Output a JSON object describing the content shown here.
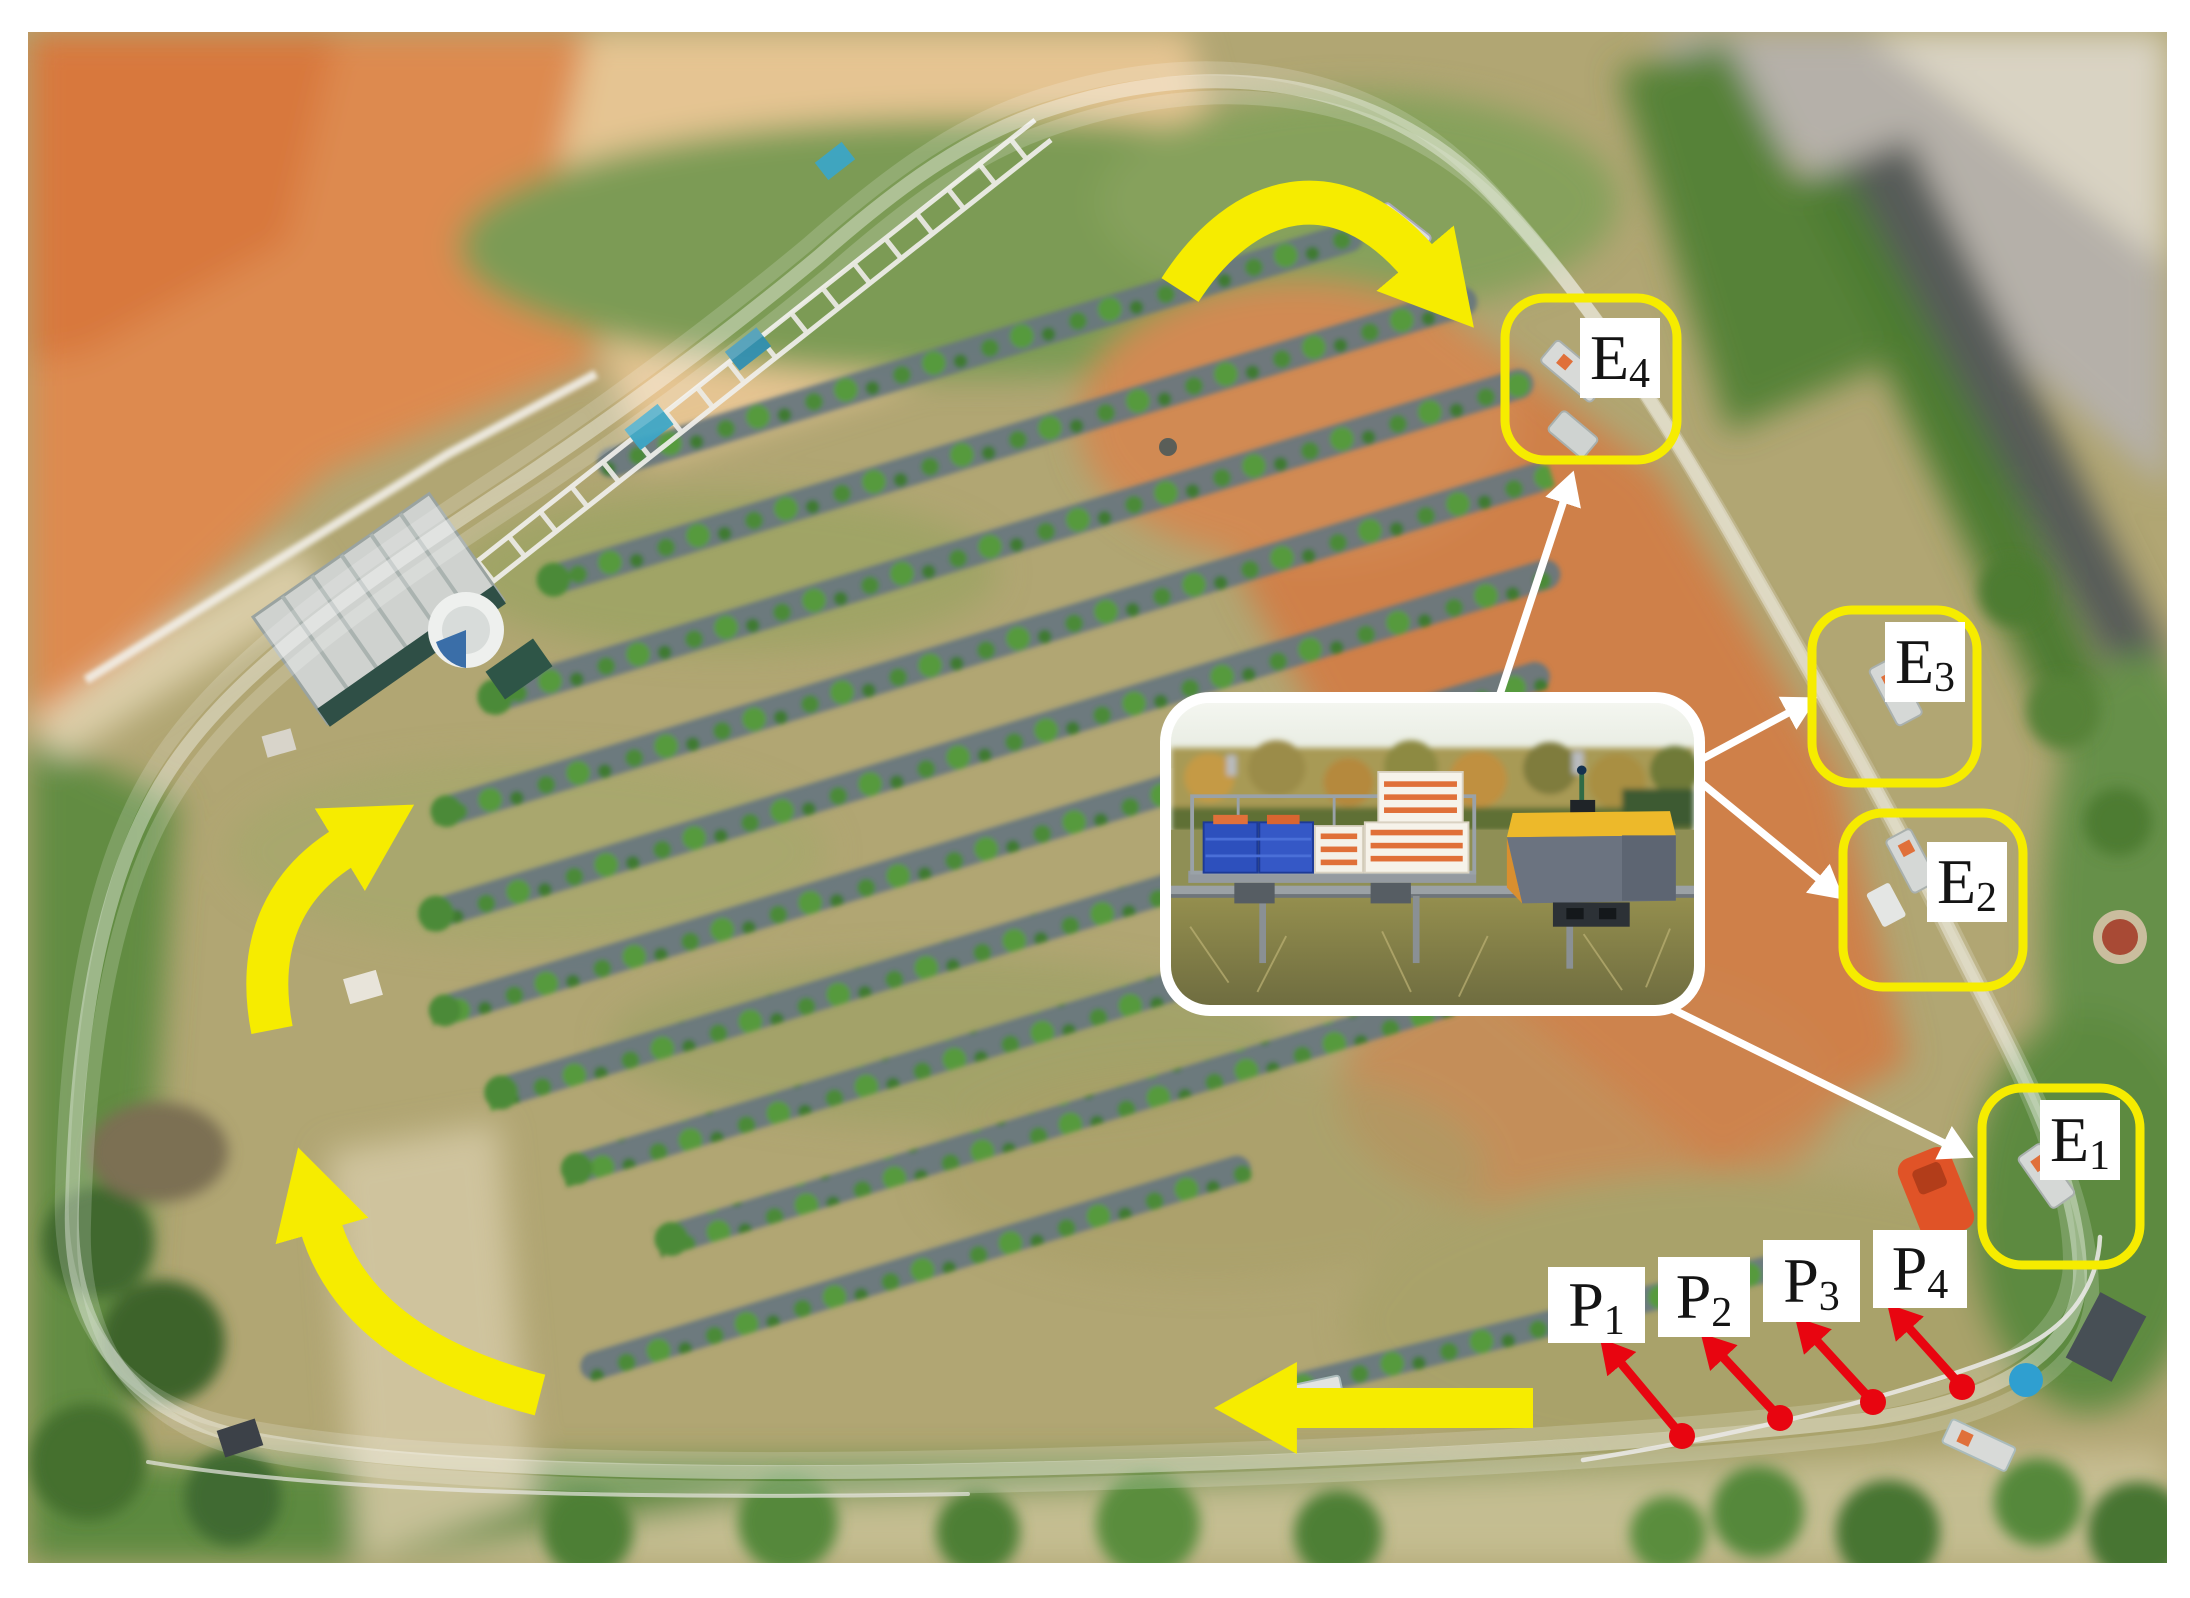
{
  "figure": {
    "title": "Aerial view of orchard monorail transport system with station and loading-point annotations"
  },
  "annotations": {
    "stations": [
      {
        "id": "E4",
        "base": "E",
        "sub": "4"
      },
      {
        "id": "E3",
        "base": "E",
        "sub": "3"
      },
      {
        "id": "E2",
        "base": "E",
        "sub": "2"
      },
      {
        "id": "E1",
        "base": "E",
        "sub": "1"
      }
    ],
    "points": [
      {
        "id": "P1",
        "base": "P",
        "sub": "1"
      },
      {
        "id": "P2",
        "base": "P",
        "sub": "2"
      },
      {
        "id": "P3",
        "base": "P",
        "sub": "3"
      },
      {
        "id": "P4",
        "base": "P",
        "sub": "4"
      }
    ],
    "route_arrows": [
      {
        "name": "route-arrow-top-curve",
        "shape": "curved",
        "direction": "down-right"
      },
      {
        "name": "route-arrow-left-upper-curve",
        "shape": "curved",
        "direction": "up-right"
      },
      {
        "name": "route-arrow-left-lower-curve",
        "shape": "curved",
        "direction": "up"
      },
      {
        "name": "route-arrow-bottom-straight",
        "shape": "straight",
        "direction": "left"
      }
    ],
    "pointer_arrows_white": [
      "to-E4",
      "to-E3",
      "to-E2",
      "to-E1"
    ],
    "pointer_arrows_red": [
      "to-P1",
      "to-P2",
      "to-P3",
      "to-P4"
    ]
  },
  "colors": {
    "route_yellow": "#f6ec00",
    "marker_red": "#e80510",
    "pointer_white": "#ffffff",
    "label_bg": "#ffffff",
    "label_text": "#141414"
  }
}
